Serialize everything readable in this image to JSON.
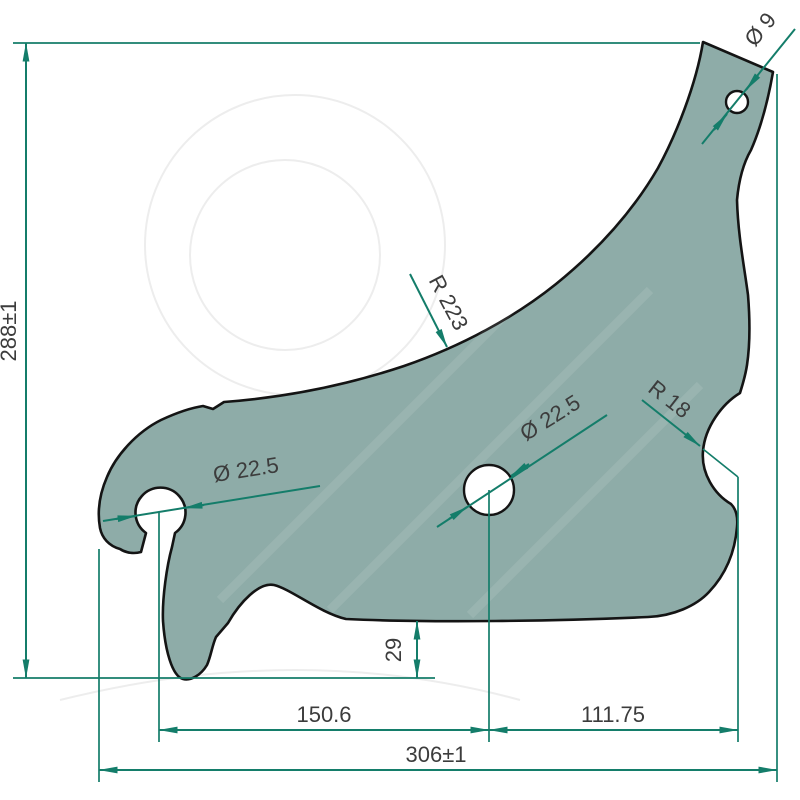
{
  "drawing": {
    "labels": {
      "overall_height": "288±1",
      "overall_width": "306±1",
      "left_hole_to_center_hole": "150.6",
      "center_hole_to_notch": "111.75",
      "foot_offset": "29",
      "left_hole_diameter": "Ø 22.5",
      "center_hole_diameter": "Ø 22.5",
      "top_hole_diameter": "Ø 9",
      "edge_radius": "R 223",
      "notch_radius": "R 18"
    },
    "colors": {
      "background": "#ffffff",
      "part_fill": "#8eaca8",
      "part_outline": "#141414",
      "dimension": "#147d6a",
      "label_text": "#3c3c3c",
      "watermark": "#ededed"
    }
  }
}
